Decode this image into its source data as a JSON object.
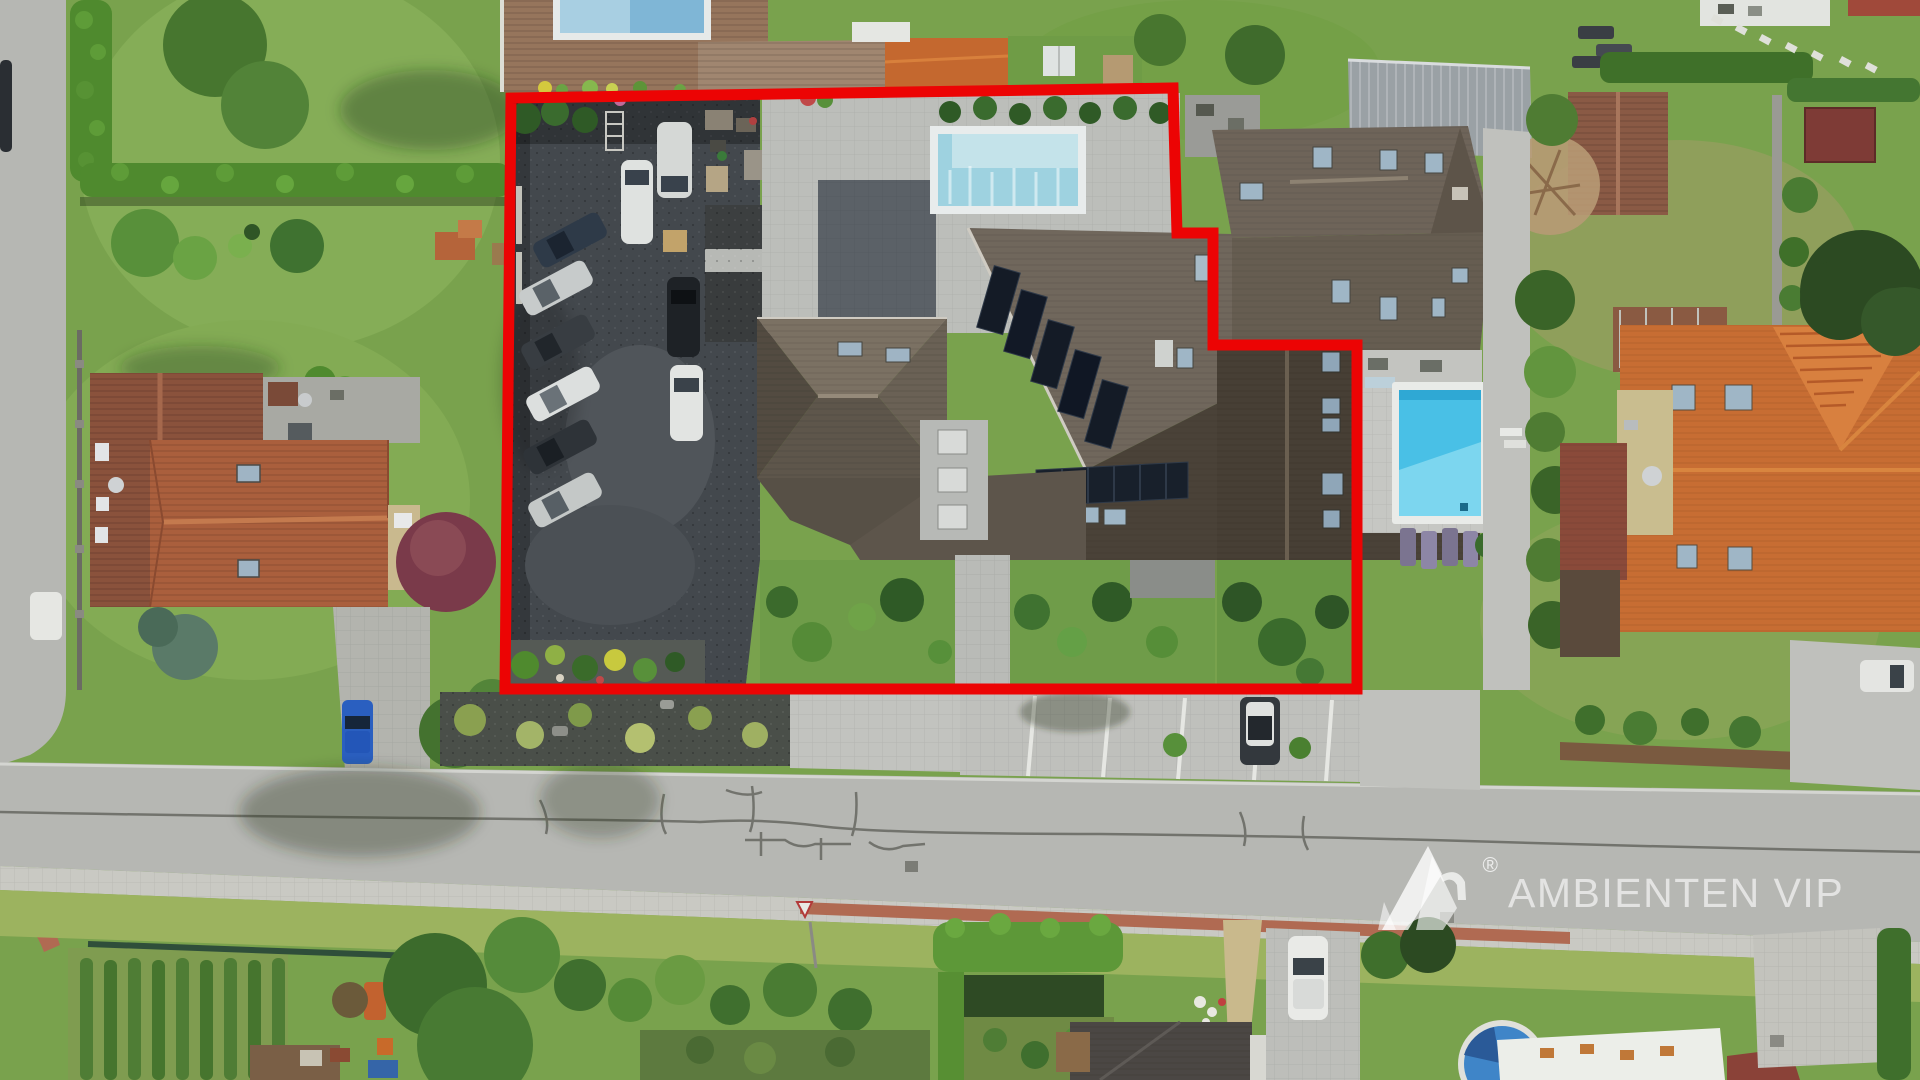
{
  "image": {
    "type": "aerial-drone-photo",
    "subject": "residential plot for sale outlined in red, guesthouse with gravel car park, pools, street and neighbouring houses",
    "width_px": 1920,
    "height_px": 1080
  },
  "watermark": {
    "text": "AMBIENTEN VIP",
    "registered": "®",
    "logo": "ambienten-mountain-logo",
    "color": "#ffffff"
  },
  "boundary": {
    "points": "511,98 1173,88 1177,233 1213,233 1213,345 1357,345 1357,689 505,689",
    "color": "#ec0404",
    "stroke_width": 11
  },
  "palette": {
    "lawn": "#79a24d",
    "lawn_light": "#9cb35f",
    "hedge_dark": "#3f6f2c",
    "hedge_bright": "#5e9c38",
    "road": "#b6b7b3",
    "sidewalk": "#c9c9c3",
    "red_pavers": "#b06a52",
    "gravel_lot": "#43484d",
    "main_roof": "#70675c",
    "dark_roof": "#4a4238",
    "orange_roof": "#c76d33",
    "left_house_roof": "#aa5f3d",
    "metal_roof": "#9aa1a5",
    "solar_panel": "#141b26",
    "pool_main": "#9ed2e0",
    "pool_neighbor": "#49c0e6",
    "round_pool": "#3f85c8",
    "crack": "#72736d"
  },
  "scene": {
    "features": [
      "red-boundary-outline",
      "gravel-parking-lot",
      "main-building-dark-roof",
      "solar-panels",
      "terrace-pool",
      "neighbor-pool-with-loungers",
      "street-with-cracks",
      "sidewalk-red-band",
      "left-house-orange-roof",
      "far-right-orange-roof-house",
      "metal-roof-shed",
      "vine-rows-garden",
      "hedge-arch-garden",
      "round-garden-pool",
      "white-membrane-roof",
      "yield-sign"
    ],
    "parked_cars": {
      "gravel_lot_angled": 6,
      "gravel_lot_straight": 4,
      "street_bay": 1,
      "bottom_driveway": 1,
      "right_edge": 2,
      "left_road": 2,
      "blue_car_left_driveway": 1
    },
    "solar_panels_staircase": 5,
    "vine_rows": 9,
    "sun_loungers": 4
  }
}
